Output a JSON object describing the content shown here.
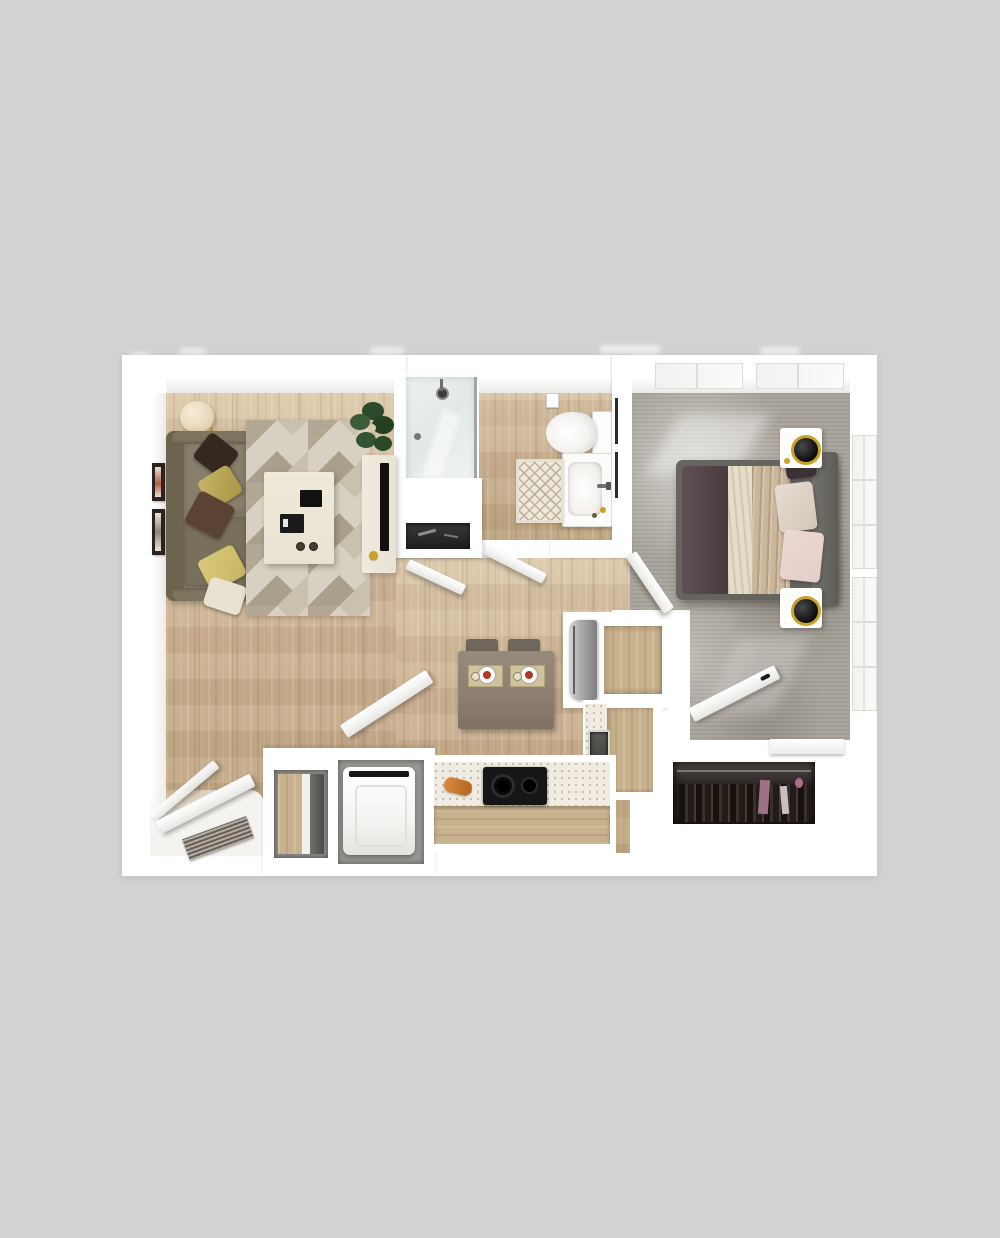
{
  "image": {
    "kind": "3d-floorplan-render",
    "unit_type": "one-bedroom one-bath apartment",
    "rooms": [
      "living-room",
      "bathroom",
      "bedroom",
      "kitchen",
      "entry",
      "laundry-closet",
      "bedroom-closet",
      "hallway"
    ]
  },
  "scene": {
    "living_room": [
      "floor-lamp",
      "sofa",
      "throw-pillows",
      "wall-art-frames",
      "geometric-rug",
      "coffee-table",
      "remotes-and-books",
      "potted-plant",
      "tv-console",
      "flat-tv"
    ],
    "bathroom": [
      "glass-shower",
      "toilet",
      "toilet-paper-holder",
      "vanity-sink",
      "faucet",
      "towel-bars",
      "diamond-bath-mat"
    ],
    "bedroom": [
      "queen-bed",
      "headboard",
      "dark-blanket",
      "draped-sheets",
      "blush-pillows",
      "nightstand-top",
      "nightstand-bottom",
      "sphere-lamps",
      "ceiling-windows",
      "wall-windows",
      "closet-with-clothes",
      "closet-door",
      "bench-shelf"
    ],
    "kitchen": [
      "refrigerator",
      "open-cabinet-nook",
      "sink",
      "l-shaped-counter",
      "cooktop",
      "bread-loaf",
      "dining-table",
      "two-chairs",
      "place-settings"
    ],
    "entry": [
      "entry-door",
      "door-mat"
    ],
    "laundry_closet": [
      "washer",
      "shelf-compartment",
      "open-closet-door"
    ]
  },
  "palette": {
    "bg": "#d2d2d2",
    "wall": "#ffffff",
    "wall_face": "#f1f0ee",
    "wood": "#cdb394",
    "wood_light": "#dcc9ab",
    "wood_dark": "#bda47f",
    "carpet": "#a9a49b",
    "rug_base": "#d8d1c3",
    "rug_tri1": "#b2a894",
    "rug_tri2": "#c9c0ae",
    "rug_tri3": "#a99f8b",
    "sofa": "#7f7660",
    "sofa_dark": "#6d6450",
    "pillow_dark": "#33291f",
    "pillow_yellow": "#c6b565",
    "pillow_brown": "#5a4334",
    "pillow_cream": "#e9e1d2",
    "table_cream": "#e9e3d4",
    "glass": "#e2e9e8",
    "counter_speck": "#f0ece2",
    "cabinet_wood": "#c8b18d",
    "stove_black": "#161616",
    "steel": "#a8a8a8",
    "dining_taupe": "#8d8071",
    "bed_frame": "#66645f",
    "blanket": "#53464a",
    "sheet_cream": "#e6ddc8",
    "sheet_tan": "#cbb69c",
    "pillow_blush": "#e3cfc8",
    "closet_dark": "#262120",
    "accent_gold": "#c9a227",
    "food_red": "#b03a26",
    "bread": "#b5651d",
    "plant_green": "#2e4a2c",
    "mat_dark": "#8a7f72"
  }
}
